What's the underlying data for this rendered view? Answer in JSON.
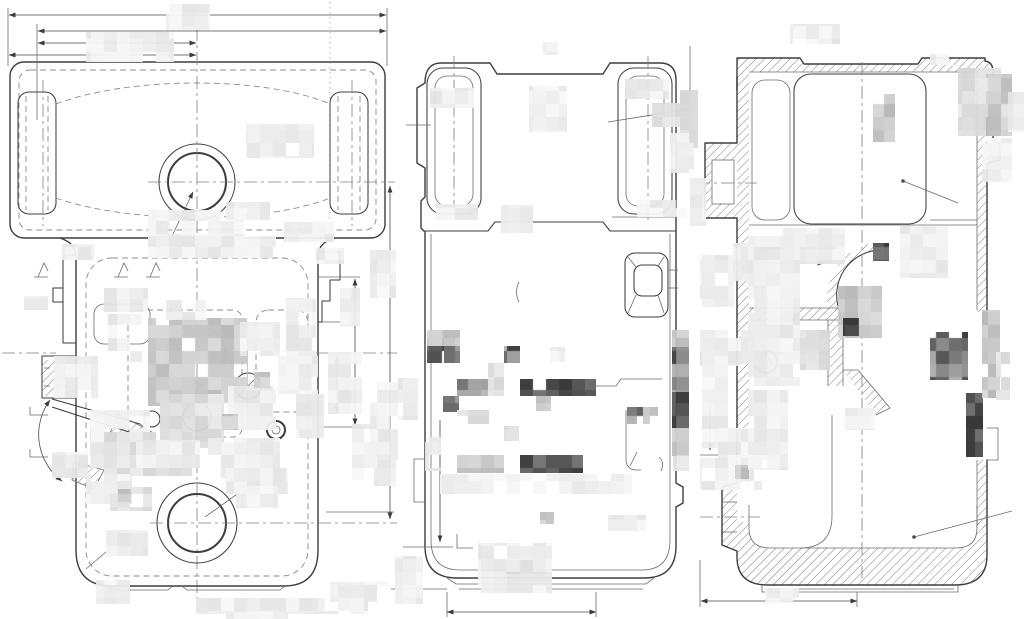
{
  "document": {
    "title": "technical-drawing-three-views",
    "background": "#ffffff"
  },
  "drawing": {
    "line_color": "#3d3d3d",
    "thin_color": "#6b6b6b",
    "dash_color": "#8c8c8c",
    "center_color": "#808080",
    "hatch_color": "#5a5a5a",
    "views": [
      {
        "id": "plan-view"
      },
      {
        "id": "front-view"
      },
      {
        "id": "section-view"
      }
    ]
  },
  "redactions": {
    "cell": 13,
    "opacity": 0.95,
    "tones": {
      "l": [
        228,
        248
      ],
      "lm": [
        212,
        236
      ],
      "m": [
        182,
        218
      ],
      "d": [
        95,
        185
      ],
      "v": [
        45,
        112
      ]
    },
    "blocks": [
      [
        166,
        4,
        44,
        26,
        "l"
      ],
      [
        86,
        32,
        88,
        30,
        "l"
      ],
      [
        246,
        124,
        68,
        34,
        "l"
      ],
      [
        148,
        210,
        96,
        30,
        "l"
      ],
      [
        226,
        202,
        44,
        18,
        "l"
      ],
      [
        148,
        236,
        128,
        22,
        "l"
      ],
      [
        284,
        222,
        50,
        20,
        "l"
      ],
      [
        62,
        244,
        32,
        16,
        "l"
      ],
      [
        316,
        248,
        28,
        16,
        "l"
      ],
      [
        104,
        288,
        44,
        24,
        "l"
      ],
      [
        24,
        296,
        24,
        14,
        "l"
      ],
      [
        108,
        314,
        34,
        48,
        "l"
      ],
      [
        148,
        318,
        100,
        88,
        "m"
      ],
      [
        240,
        322,
        40,
        34,
        "l"
      ],
      [
        286,
        298,
        30,
        62,
        "l"
      ],
      [
        54,
        356,
        44,
        42,
        "l"
      ],
      [
        90,
        410,
        60,
        58,
        "l"
      ],
      [
        160,
        394,
        64,
        54,
        "lm"
      ],
      [
        228,
        386,
        48,
        44,
        "l"
      ],
      [
        278,
        356,
        40,
        38,
        "l"
      ],
      [
        296,
        394,
        28,
        44,
        "l"
      ],
      [
        104,
        432,
        88,
        44,
        "lm"
      ],
      [
        208,
        438,
        72,
        40,
        "l"
      ],
      [
        86,
        474,
        46,
        30,
        "l"
      ],
      [
        110,
        487,
        42,
        24,
        "lm"
      ],
      [
        226,
        468,
        62,
        26,
        "l"
      ],
      [
        106,
        530,
        42,
        26,
        "l"
      ],
      [
        52,
        452,
        36,
        26,
        "l"
      ],
      [
        136,
        440,
        64,
        28,
        "l"
      ],
      [
        166,
        300,
        40,
        20,
        "l"
      ],
      [
        236,
        486,
        42,
        22,
        "l"
      ],
      [
        254,
        372,
        16,
        16,
        "m"
      ],
      [
        222,
        414,
        16,
        16,
        "m"
      ],
      [
        118,
        489,
        13,
        13,
        "m"
      ],
      [
        96,
        580,
        34,
        24,
        "l"
      ],
      [
        196,
        598,
        126,
        16,
        "l"
      ],
      [
        226,
        612,
        62,
        7,
        "l"
      ],
      [
        330,
        582,
        58,
        20,
        "l"
      ],
      [
        318,
        598,
        50,
        16,
        "l"
      ],
      [
        370,
        250,
        26,
        48,
        "l"
      ],
      [
        340,
        288,
        20,
        38,
        "l"
      ],
      [
        328,
        352,
        34,
        62,
        "l"
      ],
      [
        370,
        382,
        28,
        78,
        "l"
      ],
      [
        398,
        378,
        20,
        42,
        "l"
      ],
      [
        352,
        424,
        26,
        56,
        "l"
      ],
      [
        374,
        460,
        22,
        26,
        "l"
      ],
      [
        430,
        88,
        44,
        20,
        "l"
      ],
      [
        436,
        204,
        42,
        16,
        "l"
      ],
      [
        529,
        86,
        38,
        46,
        "l"
      ],
      [
        501,
        205,
        32,
        28,
        "l"
      ],
      [
        625,
        79,
        44,
        20,
        "l"
      ],
      [
        637,
        200,
        50,
        17,
        "l"
      ],
      [
        652,
        103,
        42,
        24,
        "lm"
      ],
      [
        680,
        90,
        18,
        58,
        "lm"
      ],
      [
        670,
        133,
        24,
        40,
        "l"
      ],
      [
        690,
        178,
        16,
        48,
        "l"
      ],
      [
        543,
        42,
        15,
        13,
        "l"
      ],
      [
        700,
        255,
        34,
        52,
        "l"
      ],
      [
        427,
        330,
        17,
        17,
        "m"
      ],
      [
        427,
        346,
        17,
        17,
        "v"
      ],
      [
        444,
        346,
        16,
        17,
        "d"
      ],
      [
        444,
        330,
        16,
        16,
        "m"
      ],
      [
        504,
        346,
        16,
        17,
        "d"
      ],
      [
        550,
        347,
        15,
        15,
        "l"
      ],
      [
        457,
        379,
        47,
        17,
        "d"
      ],
      [
        488,
        363,
        16,
        33,
        "lm"
      ],
      [
        443,
        396,
        16,
        16,
        "d"
      ],
      [
        520,
        379,
        76,
        17,
        "v"
      ],
      [
        536,
        396,
        15,
        15,
        "m"
      ],
      [
        457,
        410,
        32,
        14,
        "lm"
      ],
      [
        425,
        437,
        16,
        34,
        "l"
      ],
      [
        457,
        455,
        47,
        18,
        "m"
      ],
      [
        520,
        455,
        63,
        18,
        "v"
      ],
      [
        440,
        474,
        192,
        20,
        "l"
      ],
      [
        504,
        426,
        15,
        15,
        "lm"
      ],
      [
        540,
        512,
        14,
        12,
        "m"
      ],
      [
        608,
        515,
        38,
        16,
        "l"
      ],
      [
        478,
        543,
        74,
        50,
        "l"
      ],
      [
        506,
        560,
        40,
        14,
        "lm"
      ],
      [
        395,
        556,
        28,
        48,
        "l"
      ],
      [
        627,
        407,
        16,
        17,
        "d"
      ],
      [
        643,
        407,
        15,
        17,
        "m"
      ],
      [
        672,
        330,
        17,
        17,
        "m"
      ],
      [
        672,
        347,
        17,
        45,
        "d"
      ],
      [
        672,
        392,
        17,
        36,
        "v"
      ],
      [
        672,
        428,
        17,
        28,
        "m"
      ],
      [
        673,
        456,
        16,
        15,
        "lm"
      ],
      [
        790,
        24,
        50,
        20,
        "l"
      ],
      [
        930,
        54,
        26,
        12,
        "l"
      ],
      [
        873,
        94,
        22,
        48,
        "m"
      ],
      [
        958,
        68,
        54,
        68,
        "lm"
      ],
      [
        986,
        74,
        26,
        62,
        "m"
      ],
      [
        982,
        138,
        30,
        44,
        "l"
      ],
      [
        1008,
        92,
        16,
        40,
        "l"
      ],
      [
        733,
        243,
        28,
        38,
        "l"
      ],
      [
        783,
        228,
        62,
        36,
        "l"
      ],
      [
        900,
        226,
        48,
        52,
        "l"
      ],
      [
        873,
        243,
        16,
        18,
        "v"
      ],
      [
        838,
        286,
        44,
        52,
        "m"
      ],
      [
        843,
        318,
        16,
        18,
        "v"
      ],
      [
        930,
        332,
        38,
        48,
        "d"
      ],
      [
        966,
        393,
        17,
        64,
        "v"
      ],
      [
        982,
        310,
        18,
        88,
        "m"
      ],
      [
        996,
        352,
        14,
        48,
        "lm"
      ],
      [
        700,
        330,
        64,
        36,
        "l"
      ],
      [
        702,
        356,
        26,
        92,
        "l"
      ],
      [
        748,
        236,
        52,
        150,
        "l"
      ],
      [
        800,
        330,
        30,
        40,
        "lm"
      ],
      [
        718,
        428,
        62,
        32,
        "l"
      ],
      [
        700,
        458,
        62,
        32,
        "l"
      ],
      [
        735,
        465,
        14,
        14,
        "m"
      ],
      [
        845,
        408,
        30,
        22,
        "l"
      ],
      [
        765,
        588,
        34,
        15,
        "l"
      ],
      [
        748,
        390,
        40,
        80,
        "l"
      ]
    ]
  }
}
